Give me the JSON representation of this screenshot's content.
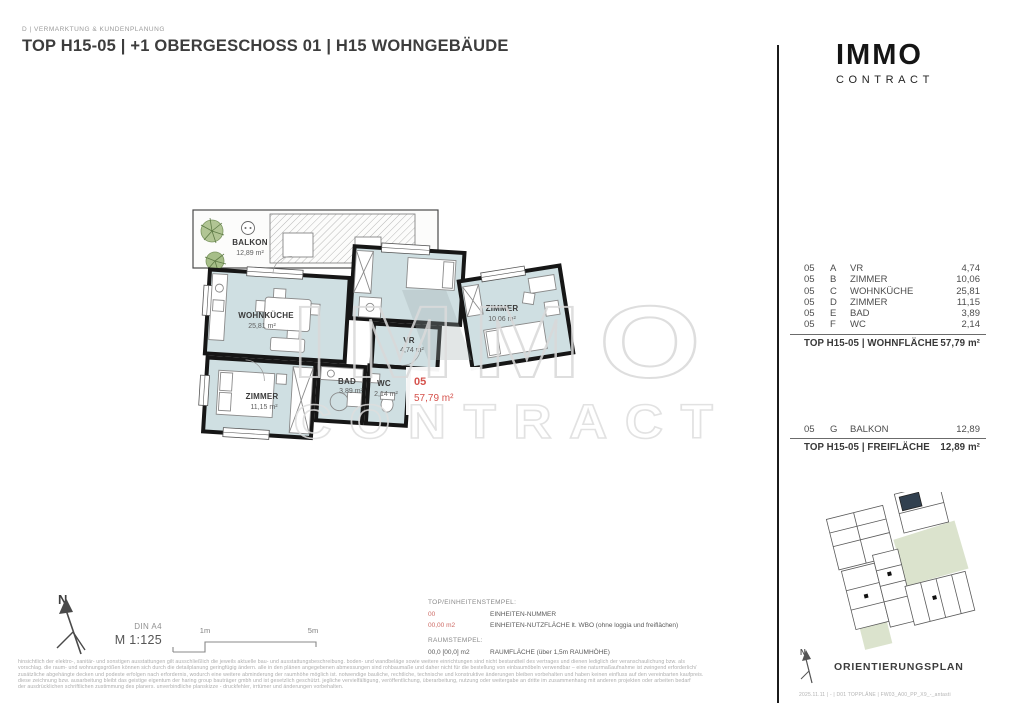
{
  "header": {
    "department": "D | VERMARKTUNG & KUNDENPLANUNG",
    "title": "TOP H15-05 | +1 OBERGESCHOSS 01 | H15 WOHNGEBÄUDE"
  },
  "logo": {
    "name": "IMMO",
    "subtitle": "CONTRACT"
  },
  "watermark": {
    "line1": "IMMO",
    "line2": "CONTRACT"
  },
  "floorplan": {
    "balkon": {
      "name": "BALKON",
      "area": "12,89 m²"
    },
    "wohnkueche": {
      "name": "WOHNKÜCHE",
      "area": "25,81 m²"
    },
    "zimmer1": {
      "name": "ZIMMER",
      "area": "11,15 m²"
    },
    "zimmer2": {
      "name": "ZIMMER",
      "area": "10,06 m²"
    },
    "vr": {
      "name": "VR",
      "area": "4,74 m²"
    },
    "bad": {
      "name": "BAD",
      "area": "3,89 m²"
    },
    "wc": {
      "name": "WC",
      "area": "2,14 m²"
    },
    "stamp": {
      "unit": "05",
      "area": "57,79 m²"
    }
  },
  "wohnflaeche_table": {
    "rows": [
      {
        "unit": "05",
        "letter": "A",
        "room": "VR",
        "area": "4,74"
      },
      {
        "unit": "05",
        "letter": "B",
        "room": "ZIMMER",
        "area": "10,06"
      },
      {
        "unit": "05",
        "letter": "C",
        "room": "WOHNKÜCHE",
        "area": "25,81"
      },
      {
        "unit": "05",
        "letter": "D",
        "room": "ZIMMER",
        "area": "11,15"
      },
      {
        "unit": "05",
        "letter": "E",
        "room": "BAD",
        "area": "3,89"
      },
      {
        "unit": "05",
        "letter": "F",
        "room": "WC",
        "area": "2,14"
      }
    ],
    "total_label": "TOP H15-05 | WOHNFLÄCHE",
    "total_value": "57,79 m²"
  },
  "freiflaeche_table": {
    "rows": [
      {
        "unit": "05",
        "letter": "G",
        "room": "BALKON",
        "area": "12,89"
      }
    ],
    "total_label": "TOP H15-05 | FREIFLÄCHE",
    "total_value": "12,89 m²"
  },
  "plan_meta": {
    "north": "N",
    "paper": "DIN A4",
    "scale": "M 1:125",
    "scale_tick_1": "1m",
    "scale_tick_2": "5m"
  },
  "legend": {
    "stamp_title": "TOP/EINHEITENSTEMPEL:",
    "unit_number_sample": "00",
    "unit_number_label": "EINHEITEN-NUMMER",
    "unit_area_sample": "00,00 m2",
    "unit_area_label": "EINHEITEN-NUTZFLÄCHE lt. WBO (ohne loggia und freiflächen)",
    "room_title": "RAUMSTEMPEL:",
    "room_area_sample": "00,0 [00,0] m2",
    "room_area_label": "RAUMFLÄCHE (über 1,5m RAUMHÖHE)"
  },
  "orientation": {
    "title": "ORIENTIERUNGSPLAN",
    "north": "N",
    "footnote": "2025.11.11 | - | D01 TOPPLÄNE | FW03_A00_PP_X9_-_antasti"
  },
  "disclaimer": {
    "lines": [
      "hinsichtlich der elektro-, sanitär- und sonstigen ausstattungen gilt ausschließlich die jeweils aktuelle bau- und ausstattungsbeschreibung. boden- und wandbeläge sowie weitere einrichtungen sind nicht bestandteil des vertrages und dienen lediglich der veranschaulichung bzw. als",
      "vorschlag. die raum- und wohnungsgrößen können sich durch die detailplanung geringfügig ändern. alle in den plänen angegebenen abmessungen sind rohbaumaße und daher nicht für die bestellung von einbaumöbeln verwendbar – eine naturmaßaufnahme ist zwingend erforderlich/",
      "zusätzliche abgehängte decken und podeste erfolgen nach erfordernis, wodurch eine weitere abminderung der raumhöhe möglich ist. notwendige bauliche, rechtliche, technische und konstruktive änderungen bleiben vorbehalten und haben keinen einfluss auf den vereinbarten kaufpreis.",
      "diese zeichnung bzw. ausarbeitung bleibt das geistige eigentum der haring group bauträger gmbh und ist gesetzlich geschützt. jegliche vervielfältigung, veröffentlichung, überarbeitung, nutzung oder weitergabe an dritte im zusammenhang mit anderen projekten oder arbeiten bedarf",
      "der ausdrücklichen schriftlichen zustimmung des planers. unverbindliche planskizze - druckfehler, irrtümer und änderungen vorbehalten."
    ]
  },
  "colors": {
    "accent_red": "#d5524c",
    "room_fill": "#cfdfe2",
    "wall": "#161616",
    "watermark": "#d9d9d9"
  }
}
